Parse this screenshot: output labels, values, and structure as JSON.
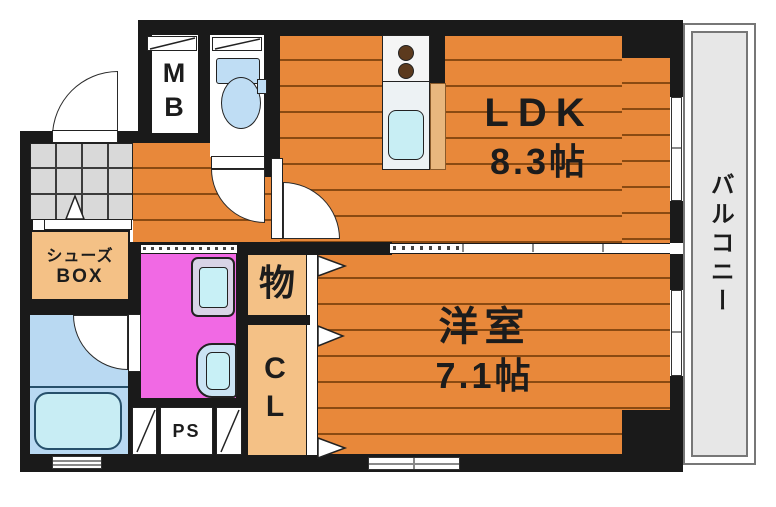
{
  "plan": {
    "ldk": {
      "name": "LDK",
      "size": "8.3帖"
    },
    "western_room": {
      "name": "洋室",
      "size": "7.1帖"
    },
    "balcony": {
      "name": "バルコニー"
    },
    "shoes_box": {
      "line1": "シューズ",
      "line2": "BOX"
    },
    "storage": {
      "name": "物"
    },
    "closet": {
      "c": "C",
      "l": "L"
    },
    "meter_box": {
      "m": "M",
      "b": "B"
    },
    "pipe_space": {
      "name": "PS"
    },
    "colors": {
      "wall": "#1a1a1a",
      "wood_floor": "#e8883a",
      "plank_line": "#8a4a12",
      "closet_tan": "#f4c186",
      "washroom_pink": "#f169e4",
      "bath_blue": "#b9d9f2",
      "bathtub_cyan": "#c8edf4",
      "fixture_blue": "#bfddf4",
      "sink_cyan": "#c8eef4",
      "balcony_gray": "#e7e7e7",
      "genkan_tile_gray": "#d9d9d9"
    }
  }
}
